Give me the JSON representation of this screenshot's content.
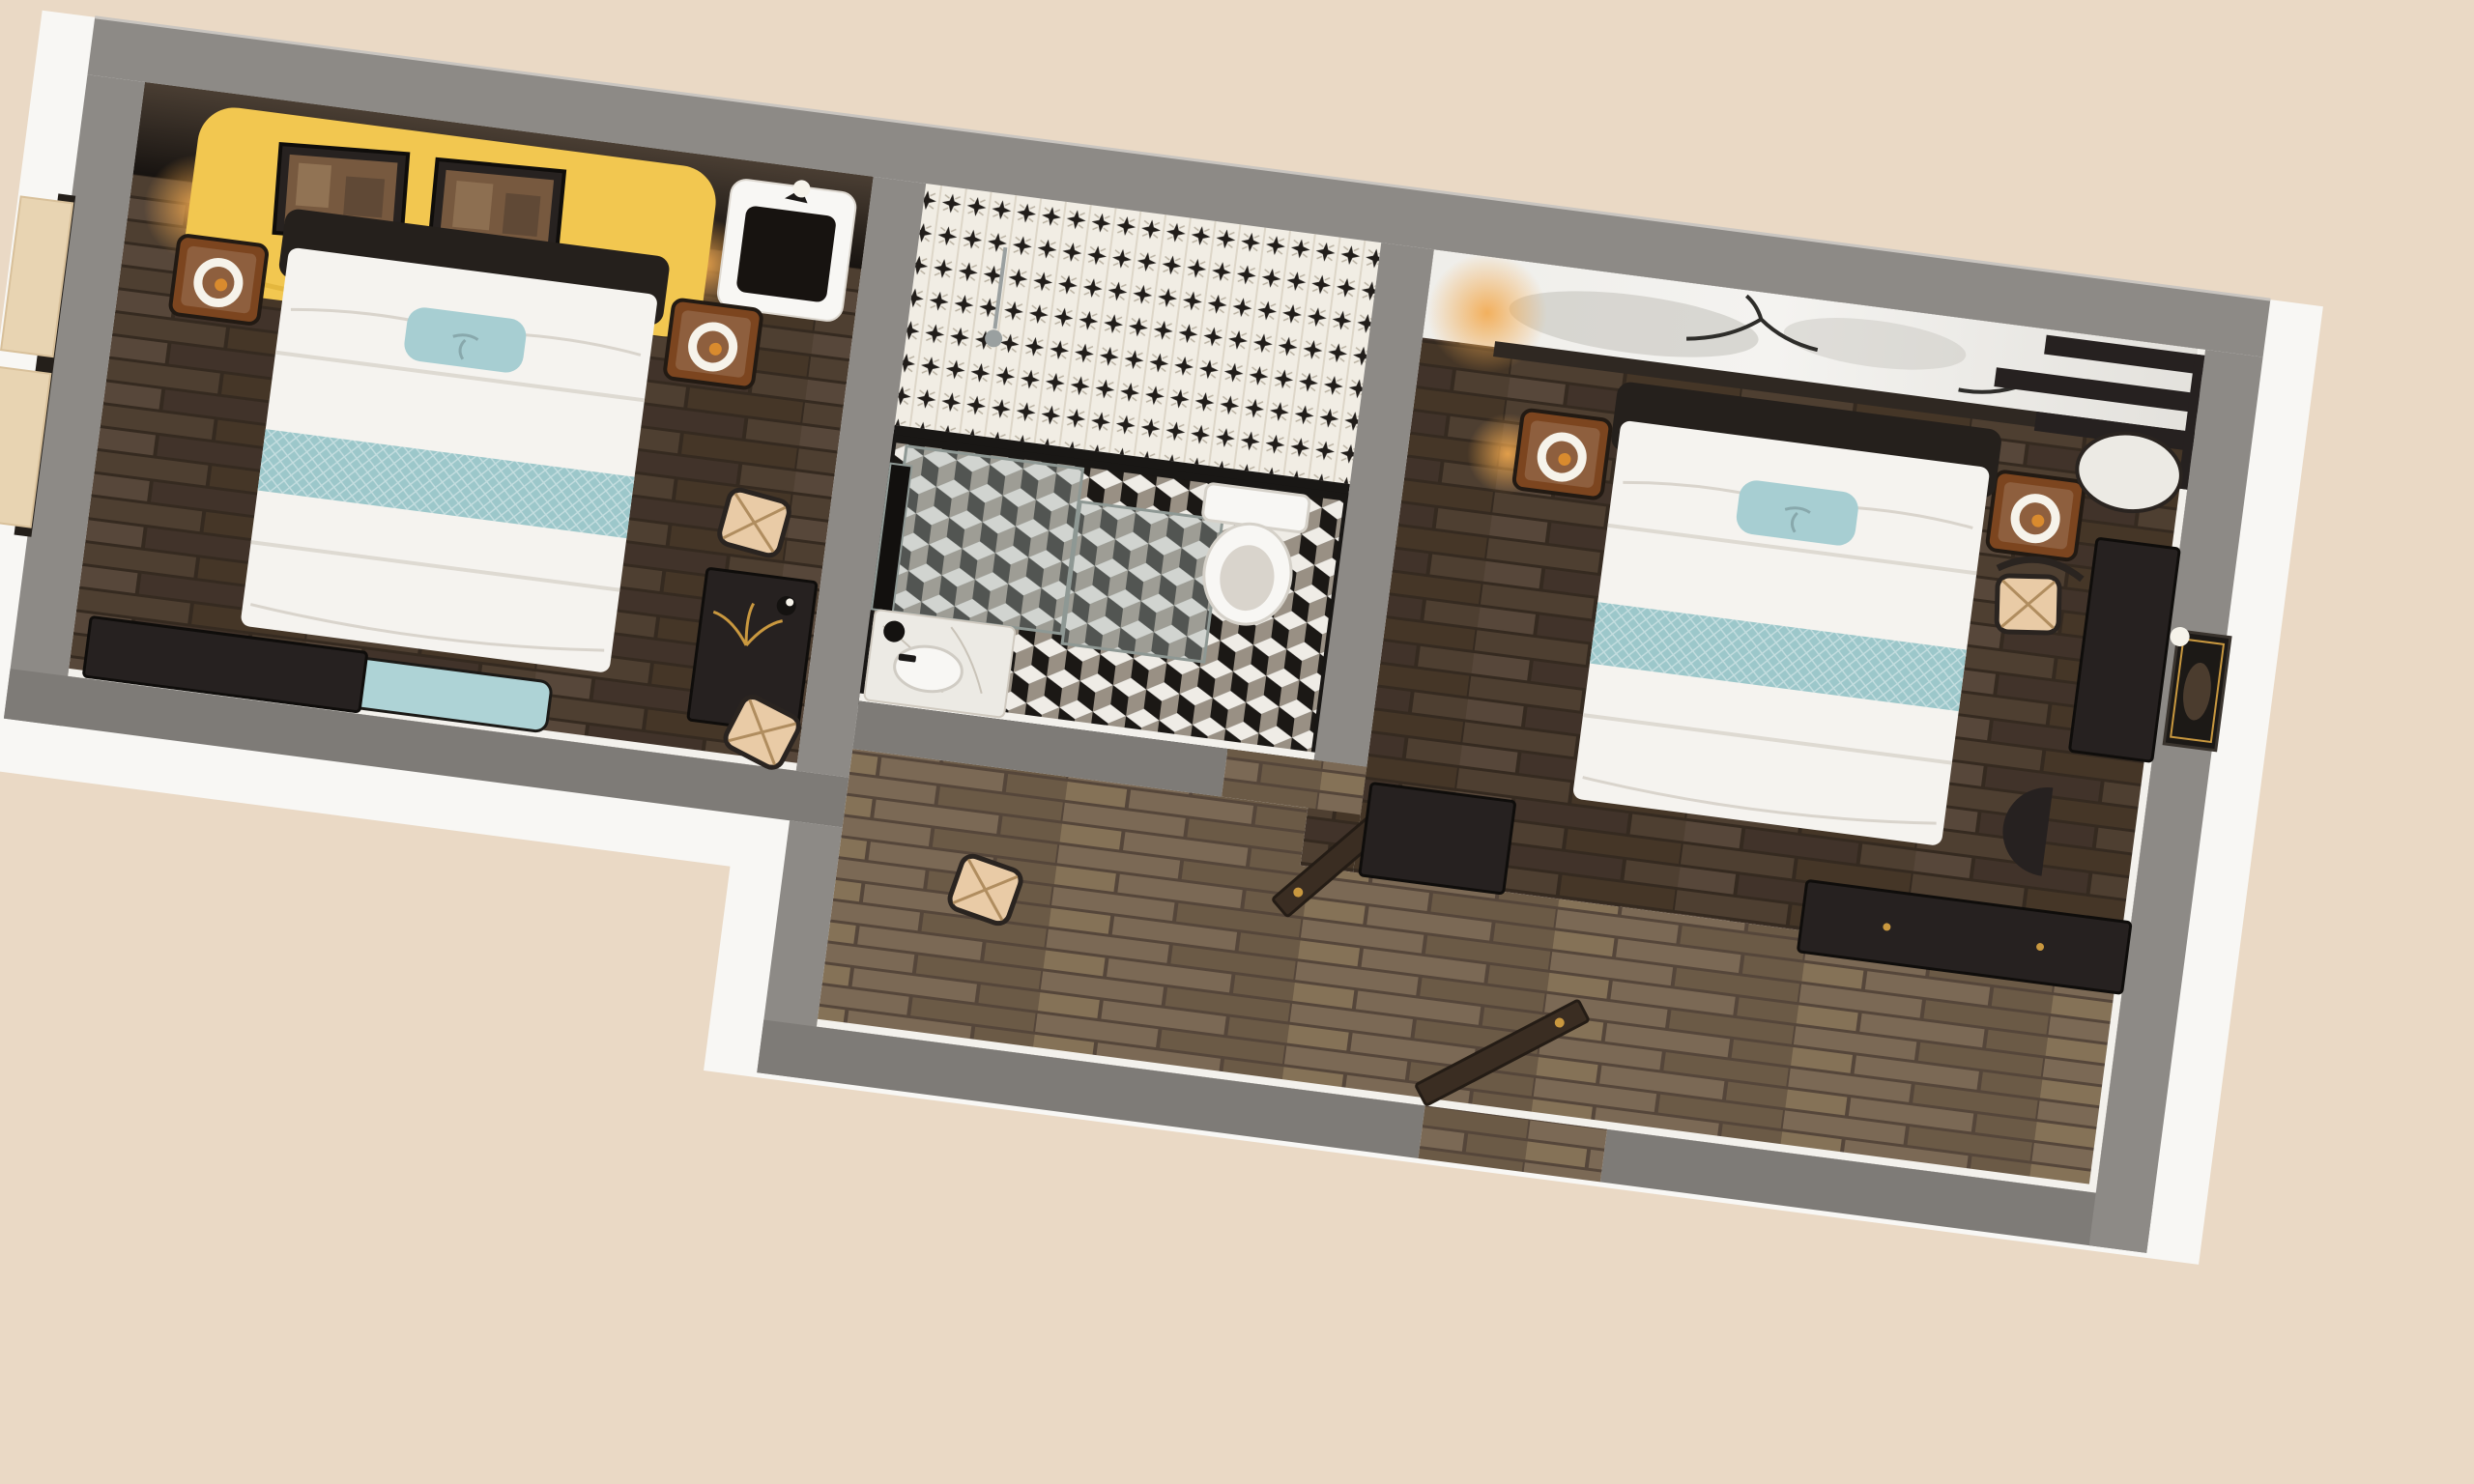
{
  "scene": {
    "title": "Isometric 3D cutaway floor plan of a hotel suite: two bedrooms flanking a central bathroom with entry corridor",
    "view": "top-down isometric render, plan rotated clockwise, no visible text"
  },
  "palette": {
    "background": "#ead9c5",
    "wall_top": "#8d8a86",
    "wall_top_dark": "#7e7b77",
    "wall_hairline": "#c9c5c0",
    "wall_outer_white": "#f8f7f4",
    "wall_inner_white": "#f3f1ec",
    "dark_wall_hi": "#4a3e33",
    "dark_wall_lo": "#171310",
    "wood_gap": "#352a20",
    "wood_plank_a": "#4e3f31",
    "wood_plank_b": "#453627",
    "wood_plank_c": "#57473a",
    "wood_plank_d": "#41332a",
    "woodlight_gap": "#55463a",
    "woodlight_a": "#7b6955",
    "woodlight_b": "#6b5a46",
    "woodlight_c": "#857257",
    "headboard_yellow": "#f2c750",
    "headboard_yellow_shade": "#d9a92f",
    "art_frame": "#272220",
    "art_canvas": "#77593f",
    "art_blotch": "#9c7f5e",
    "leather_dark": "#25201c",
    "bed_white": "#f5f3ef",
    "bed_shadow": "#d9d4cc",
    "pillow_teal": "#a7ced2",
    "runner_teal": "#9cc7ca",
    "bench_teal": "#aed3d6",
    "furniture_dark": "#262120",
    "furniture_edge": "#0f0d0b",
    "nightstand_wood": "#7c451f",
    "nightstand_sheen": "#a05a28",
    "lamp_ring": "#f6f3ea",
    "lamp_glow": "#d98b2e",
    "tile_white": "#efece6",
    "tile_black": "#1b1815",
    "tile_gray": "#999084",
    "motif_bg": "#f1ede4",
    "motif_ink": "#211d1a",
    "motif_soft": "#b9b1a2",
    "motif_stripe": "#ddd6c8",
    "marble_black": "#191715",
    "marble_white": "#eceae4",
    "marble_vein": "#c9c3b8",
    "glass_fill": "rgba(164,178,175,0.40)",
    "glass_edge": "#8e9894",
    "ceramic": "#f8f7f4",
    "ceramic_shade": "#d5d1c9",
    "chair_tan": "#e9cba6",
    "chair_tan_line": "#b08d5f",
    "chair_frame": "#2a2420",
    "curtain": "#e8d4b2",
    "curtain_edge": "#d8c09a",
    "mural_light": "#f2f1ee",
    "mural_gray": "#c9c7c1",
    "mural_ink": "#2e2d2a",
    "gold": "#c9983f",
    "door_wood": "#3a2d22",
    "steel": "#9aa0a0"
  },
  "rooms": {
    "left_bedroom": {
      "name": "Bedroom 1",
      "furniture": [
        "yellow sculpted headboard wall with two framed artworks",
        "double bed with white linens",
        "teal accent pillow",
        "teal jacquard bed runner",
        "teal upholstered bench",
        "pair of nightstands with ring lamps",
        "vanity mirror unit with sconce",
        "writing desk with gold palm decor",
        "woven-seat chair",
        "woven stool",
        "TV console",
        "window with beige curtains"
      ]
    },
    "bathroom": {
      "name": "Bathroom",
      "furniture": [
        "black and white motif tiled wall",
        "cubic illusion tile floor",
        "walk-in shower with glass partition and handset",
        "toilet",
        "marble vanity with vessel sink",
        "tall framed mirror",
        "black table lamp",
        "swing door with gold handle"
      ]
    },
    "right_bedroom": {
      "name": "Bedroom 2",
      "furniture": [
        "ink-wash mountain mural headboard wall",
        "staggered dark wood shelves",
        "double bed with white linens",
        "teal accent pillow",
        "teal jacquard bed runner",
        "pair of nightstands with ring lamps",
        "round side table",
        "desk against east wall",
        "wishbone chair with woven seat",
        "framed artwork with picture light",
        "half-round console",
        "dresser",
        "long dark sideboard"
      ]
    },
    "corridor": {
      "name": "Entry corridor",
      "furniture": [
        "light oak plank flooring",
        "open entry door",
        "woven stool"
      ]
    }
  }
}
